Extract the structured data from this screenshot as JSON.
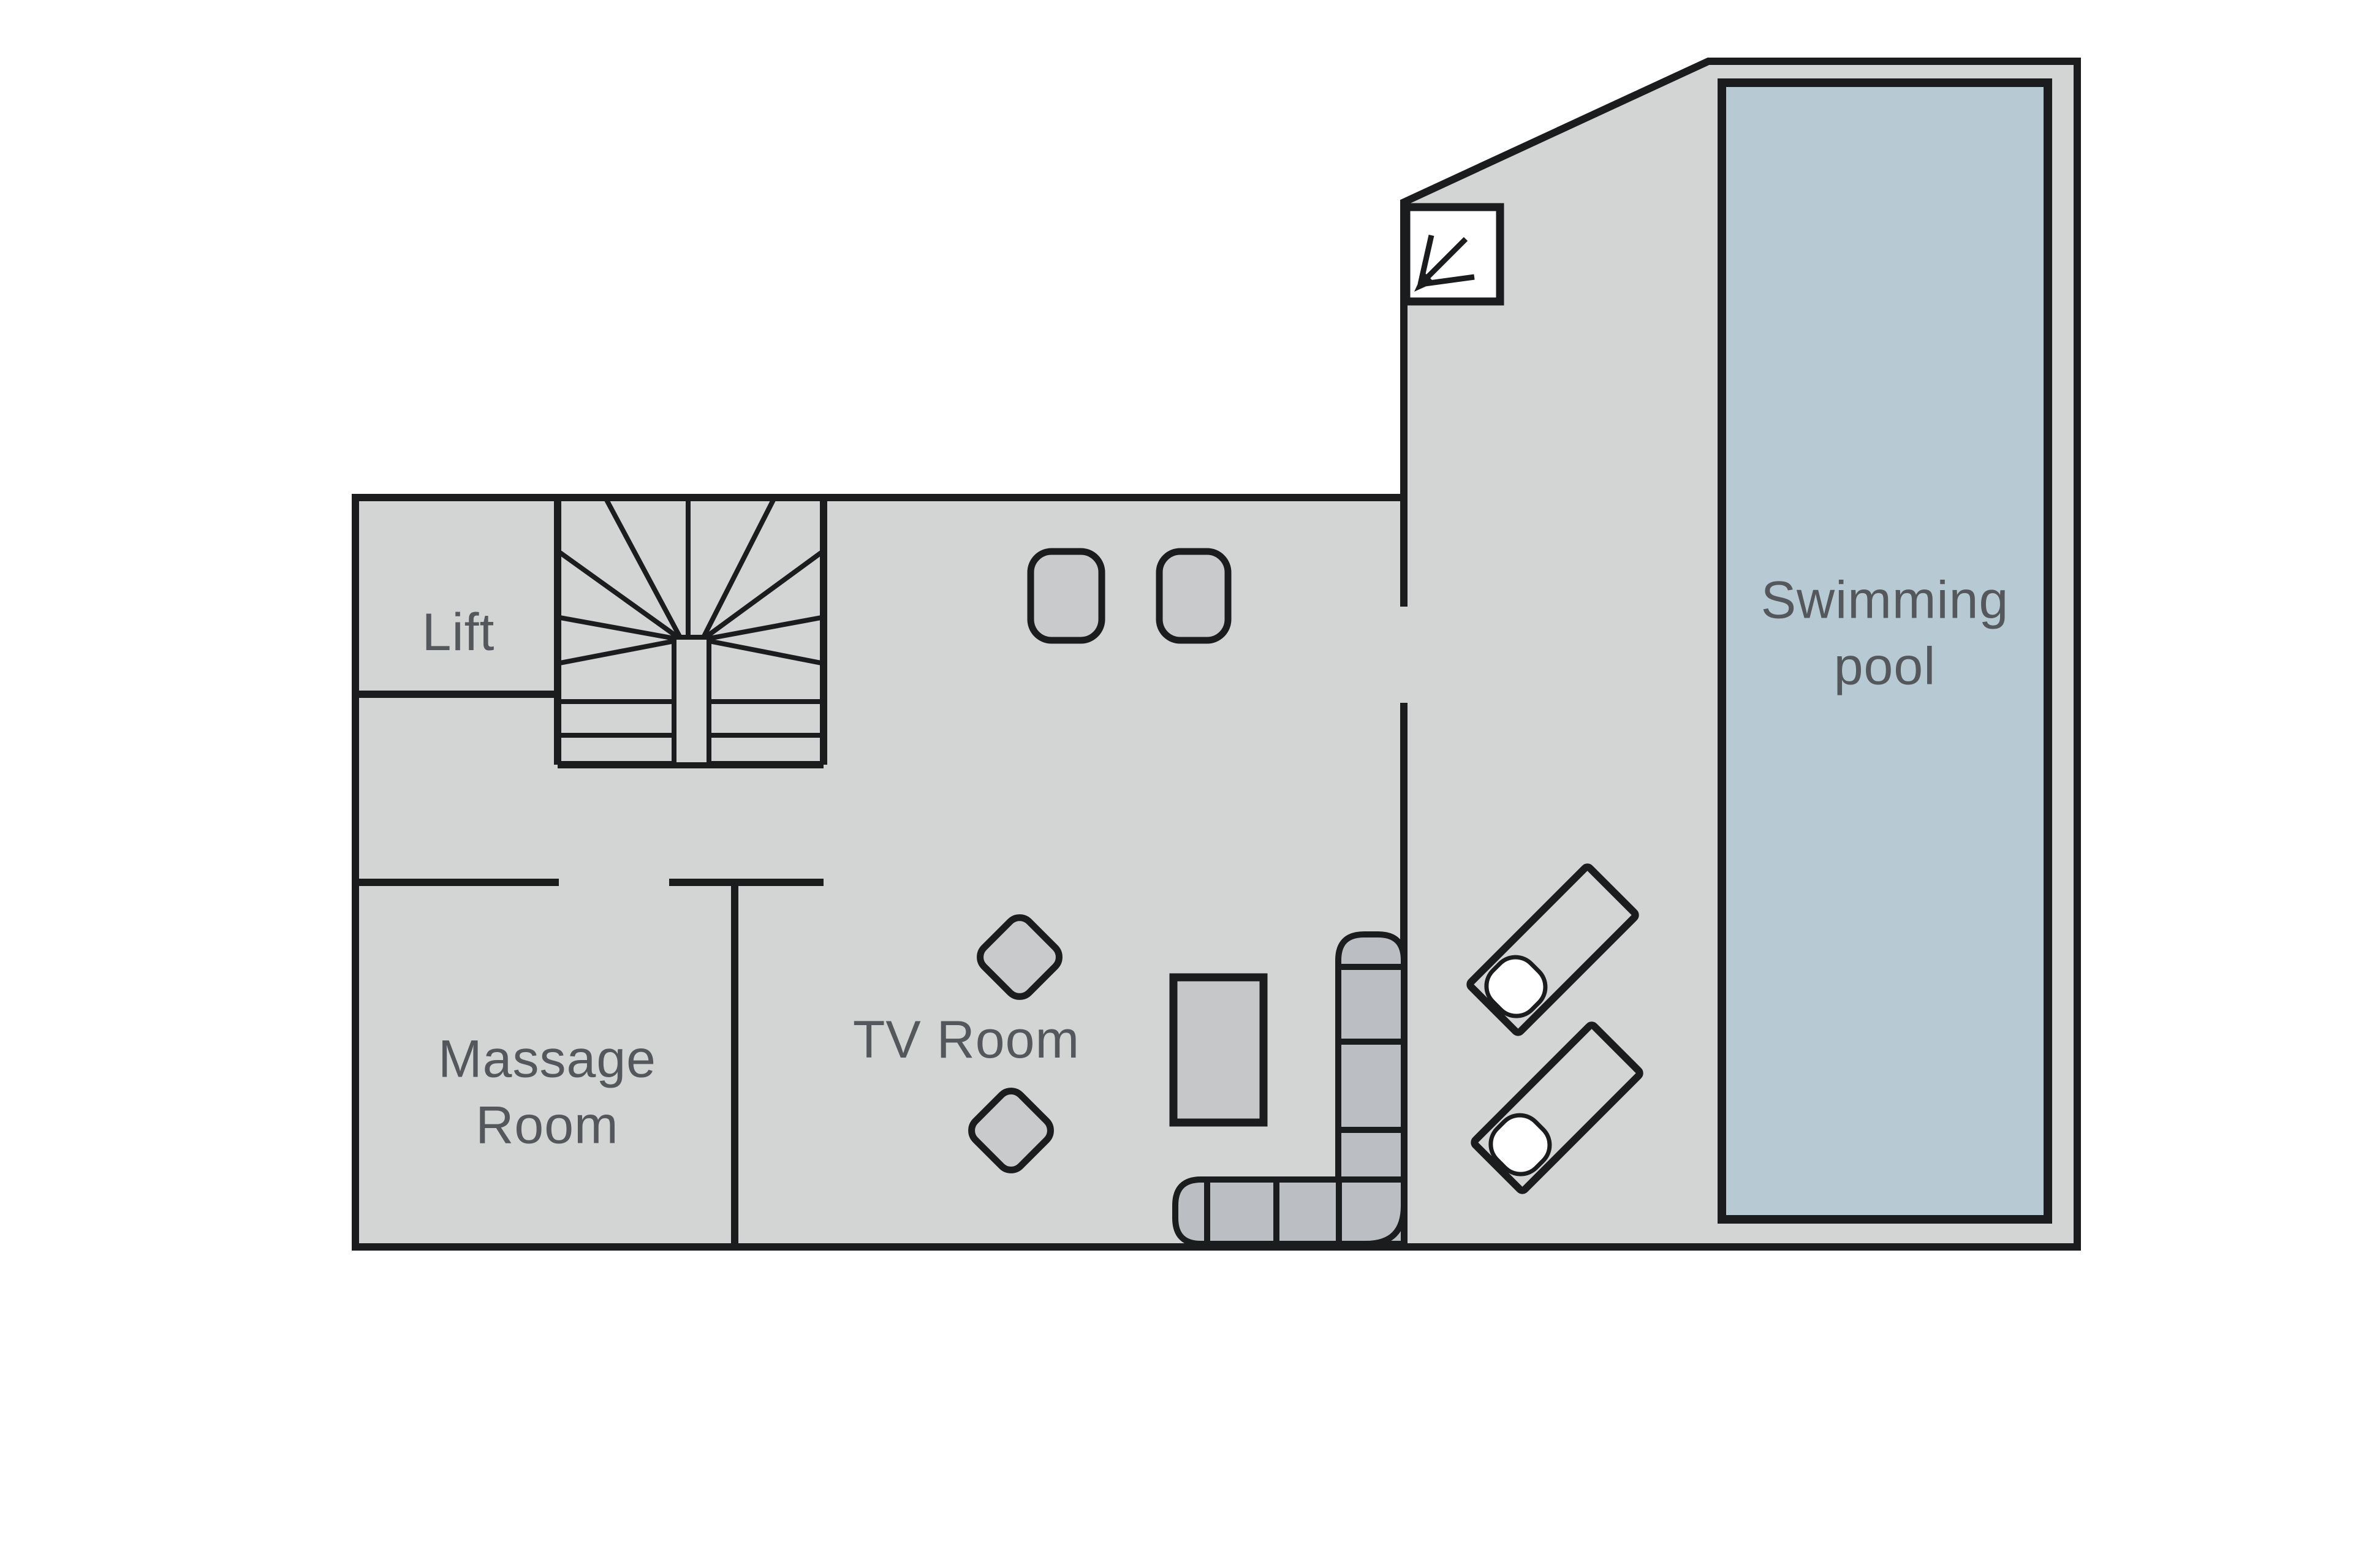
{
  "title": "Floor plan",
  "rooms": {
    "lift": {
      "label": "Lift"
    },
    "massage_room": {
      "label_line1": "Massage",
      "label_line2": "Room"
    },
    "tv_room": {
      "label": "TV Room"
    },
    "swimming_pool": {
      "label_line1": "Swimming",
      "label_line2": "pool"
    }
  },
  "furniture": {
    "stool_count": 2,
    "armchair_count": 2,
    "coffee_table_count": 1,
    "sofa_sections": 7,
    "sun_lounger_count": 2,
    "staircase_count": 1,
    "view_arrow_count": 1
  },
  "colors": {
    "floor": "#d3d5d4",
    "wall": "#1a1c1e",
    "pool_water": "#b7cad3",
    "furniture_fill": "#c8cacc",
    "sofa_fill": "#bbbec2",
    "table_fill": "#c5c7c9",
    "label_text": "#54575b",
    "pillow": "#ffffff",
    "background": "#ffffff"
  }
}
